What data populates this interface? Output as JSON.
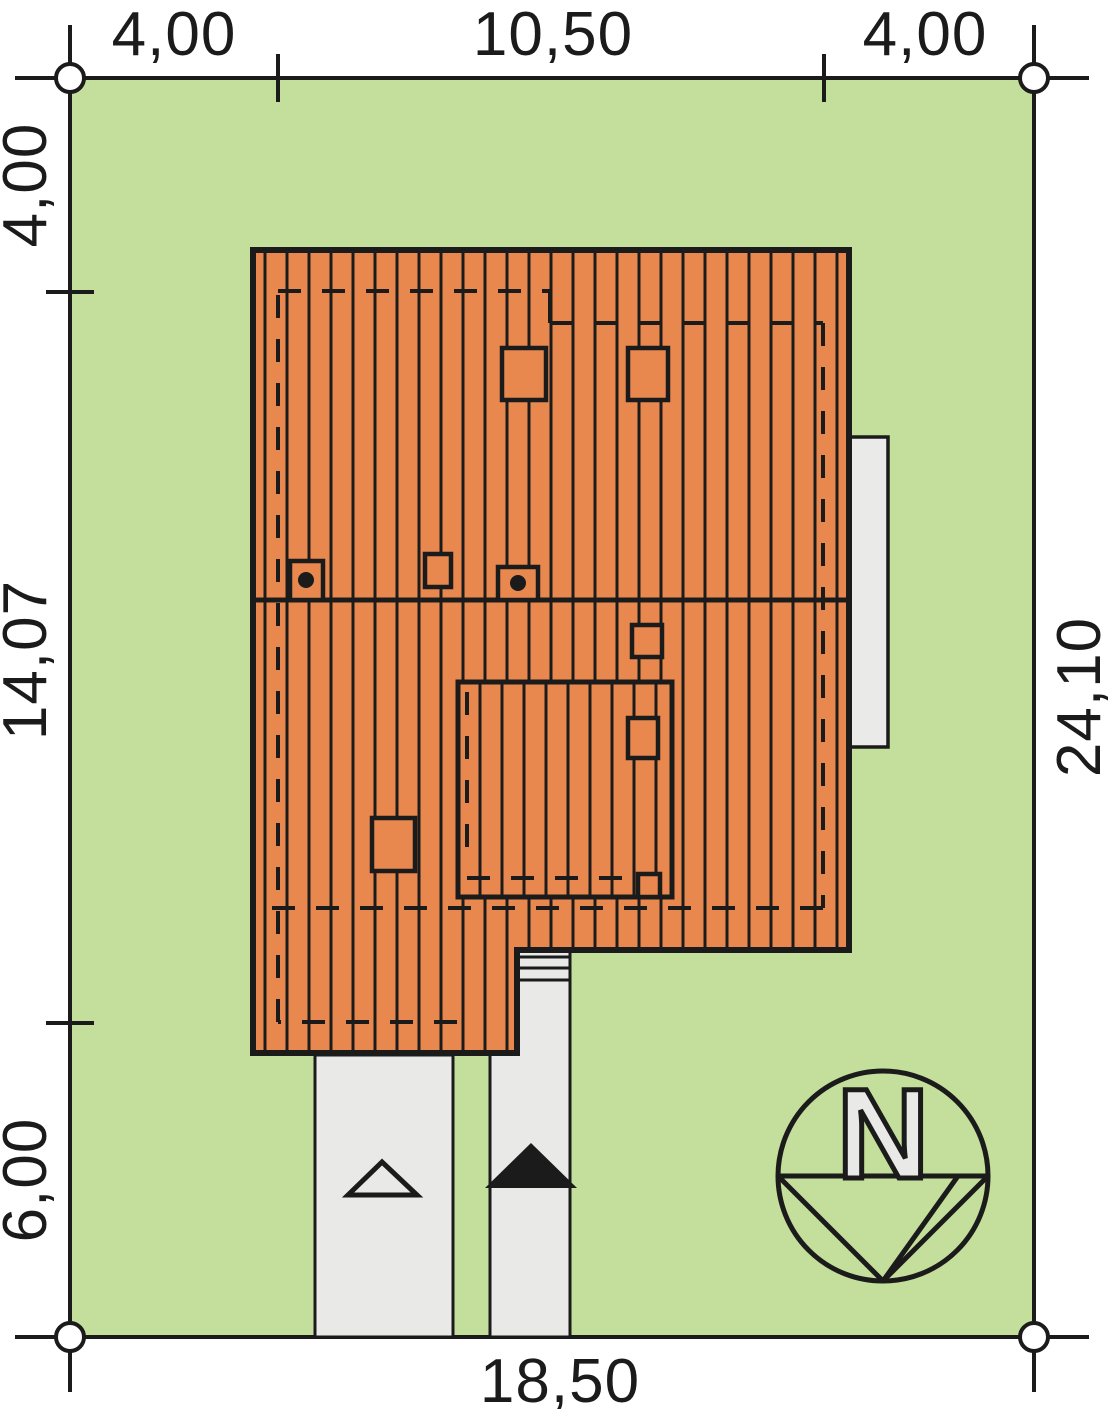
{
  "title": "site-plan-drawing",
  "dimensions": {
    "top": [
      "4,00",
      "10,50",
      "4,00"
    ],
    "left": [
      "4,00",
      "14,07",
      "6,00"
    ],
    "right": [
      "24,10"
    ],
    "bottom": [
      "18,50"
    ]
  },
  "compass": {
    "north_label": "N"
  },
  "colors": {
    "plot_green": "#c3df9b",
    "roof_orange": "#e8884f",
    "line_black": "#1b1b1b",
    "path_gray": "#e9e9e7",
    "terrace_gray": "#eaeae8"
  }
}
